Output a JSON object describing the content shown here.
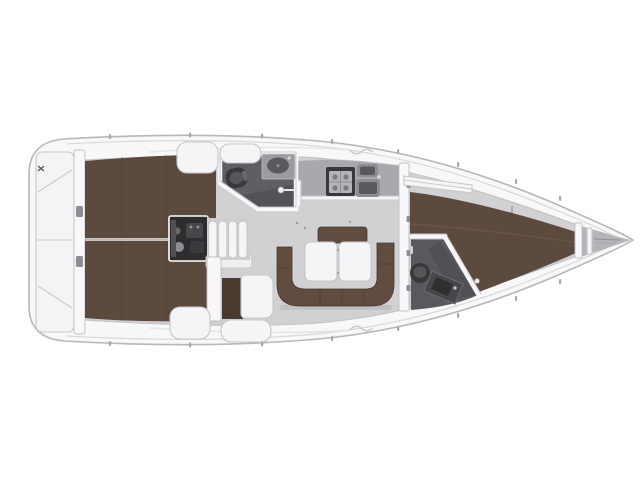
{
  "image": {
    "type": "sailing-yacht-interior-floor-plan",
    "view": "top-down",
    "orientation": "bow-right, stern-left",
    "background": "plain white, no text or labels visible"
  },
  "colors": {
    "page_bg": "#ffffff",
    "hull_fill": "#f8f8f9",
    "hull_stroke": "#b7b7ba",
    "deck_line": "#d9d9dc",
    "coach_line": "#e4e4e7",
    "interior_floor": "#d1d1d4",
    "interior_stroke": "#c2c2c5",
    "wood": "#5d4a3f",
    "wood_seam": "#493a30",
    "wood_light": "#6e594c",
    "wood_entry": "#4a3b31",
    "sofa": "#604c41",
    "counter": "#a9a9ad",
    "head_floor": "#5f5f63",
    "head_floor_dark": "#4f4f53",
    "fixture": "#39393c",
    "fixture_mid": "#8e8e92",
    "basin": "#5a5a5e",
    "engine": "#2d2d2f",
    "white_furniture": "#f5f5f7",
    "furniture_stroke": "#c6c6c9",
    "wall": "#f8f8fa",
    "wall_stroke": "#bfbfc2",
    "metal": "#a5a5a9",
    "locker_gray": "#b5b5b9"
  },
  "regions": {
    "stern_transom": "transom-platform",
    "aft_bulkhead": "stern-bulkhead",
    "aft_cabin_port": "aft-double-berth-top",
    "aft_cabin_starboard": "aft-double-berth-bottom",
    "engine_compartment": "engine-under-companionway",
    "companionway": "companionway-steps",
    "aft_head": "wc-with-basin-and-shower",
    "galley": "stove-and-double-sink",
    "salon": "u-shaped-sofa-with-folding-table",
    "nav_seat": "seat-beside-companionway",
    "forward_head": "wc-with-vanity",
    "forward_cabin": "v-berth",
    "anchor_locker": "bow-anchor-locker"
  },
  "fixtures": [
    "toilet-aft-head",
    "oval-basin-aft-head",
    "shower-mixer-aft-head",
    "two-burner-stove",
    "double-sink",
    "folding-table-two-leaves",
    "toilet-forward-head",
    "vanity-forward-head",
    "companionway-steps-4",
    "engine-block",
    "anchor-locker-divider"
  ]
}
